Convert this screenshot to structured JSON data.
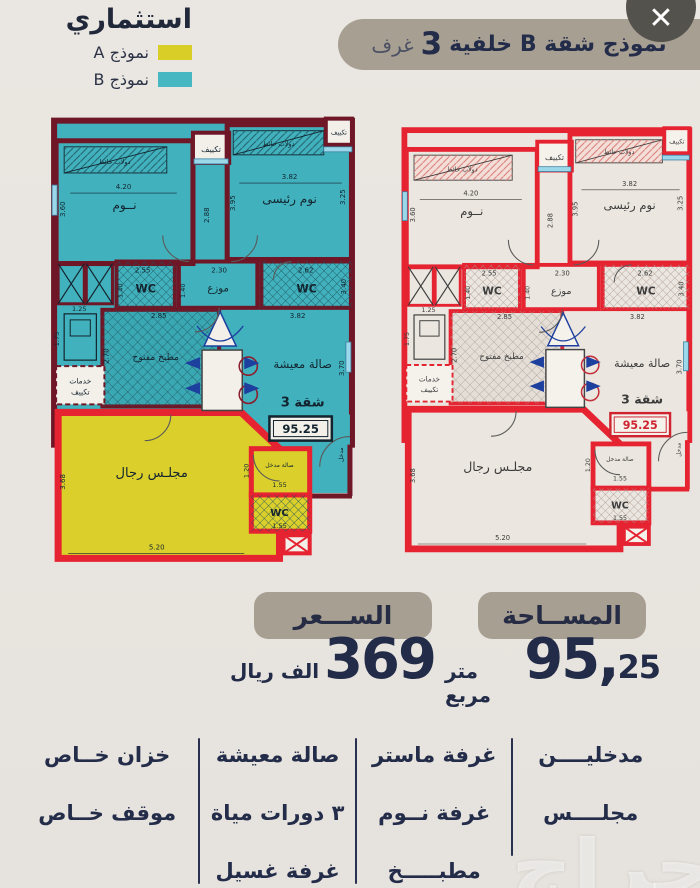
{
  "legend": {
    "title": "استثماري",
    "items": [
      {
        "label": "نموذج A",
        "color": "#d9cd28"
      },
      {
        "label": "نموذج B",
        "color": "#47b7c1"
      }
    ]
  },
  "title_banner": {
    "main": "نموذج شقة B خلفية",
    "number": "3",
    "suffix": "غرف"
  },
  "close_button": {
    "glyph": "✕"
  },
  "floor_plans": {
    "labels": {
      "bedroom": "نــوم",
      "master": "نوم رئيسى",
      "closet": "دولاب حائط",
      "ac": "تكييف",
      "wc": "WC",
      "hall": "موزع",
      "kitchen": "مطبخ مفتوح",
      "living": "صالة معيشة",
      "apartment": "شقة 3",
      "apartment_area": "95.25",
      "services_1": "خدمات",
      "services_2": "تكييف",
      "majlis": "مجلـس رجال",
      "entry_hall": "صالة مدخل",
      "entrance": "مدخل"
    },
    "dimensions": {
      "d420": "4.20",
      "d360": "3.60",
      "d382": "3.82",
      "d395": "3.95",
      "d288": "2.88",
      "d325": "3.25",
      "d255": "2.55",
      "d230": "2.30",
      "d262": "2.62",
      "d140": "1.40",
      "d340": "3.40",
      "d125": "1.25",
      "d285": "2.85",
      "d175": "1.75",
      "d270": "2.70",
      "d370": "3.70",
      "d368": "3.68",
      "d520": "5.20",
      "d120": "1.20",
      "d155": "1.55"
    },
    "variants": [
      {
        "name": "model-b-colored",
        "wall": "#6f1727",
        "wall2": "#e52331",
        "room": "#41b2bd",
        "kitchen": "#3aa8b3",
        "majlis": "#dbd02b",
        "white": "#f3f0ea",
        "text": "#13242f",
        "closetBg": "none",
        "hatch1": "#225d69",
        "hatch2": "#1e4f5a",
        "hatch3": "#1e5560",
        "accent": "#1d3f9e",
        "circle": "#8c1f2f",
        "areaBox": "#13242f",
        "areaText": "#13242f"
      },
      {
        "name": "model-b-outline",
        "wall": "#e52331",
        "wall2": "#e52331",
        "room": "#ebe6df",
        "kitchen": "#e4ded6",
        "majlis": "#ebe6df",
        "white": "#f5f2ec",
        "text": "#3c3c3c",
        "closetBg": "#f4ded8",
        "hatch1": "#d77a74",
        "hatch2": "#a89890",
        "hatch3": "#a59e95",
        "accent": "#1d3f9e",
        "circle": "#c3303a",
        "areaBox": "#cf2430",
        "areaText": "#cf2430"
      }
    ]
  },
  "price": {
    "banner": "الســـعر",
    "value": "369",
    "unit": "الف ريال"
  },
  "area": {
    "banner": "المســاحة",
    "value_main": "95,",
    "value_fraction": "25",
    "unit": "متر مربع"
  },
  "features": {
    "columns": [
      {
        "items": [
          "مدخليــــن",
          "مجلــــس"
        ]
      },
      {
        "items": [
          "غرفة ماستر",
          "غرفة نــوم",
          "مطبـــــخ"
        ]
      },
      {
        "items": [
          "صالة معيشة",
          "٣ دورات مياة",
          "غرفة غسيل"
        ]
      },
      {
        "items": [
          "خزان خــاص",
          "موقف خــاص"
        ]
      }
    ]
  },
  "watermark": {
    "text": "حراج"
  }
}
